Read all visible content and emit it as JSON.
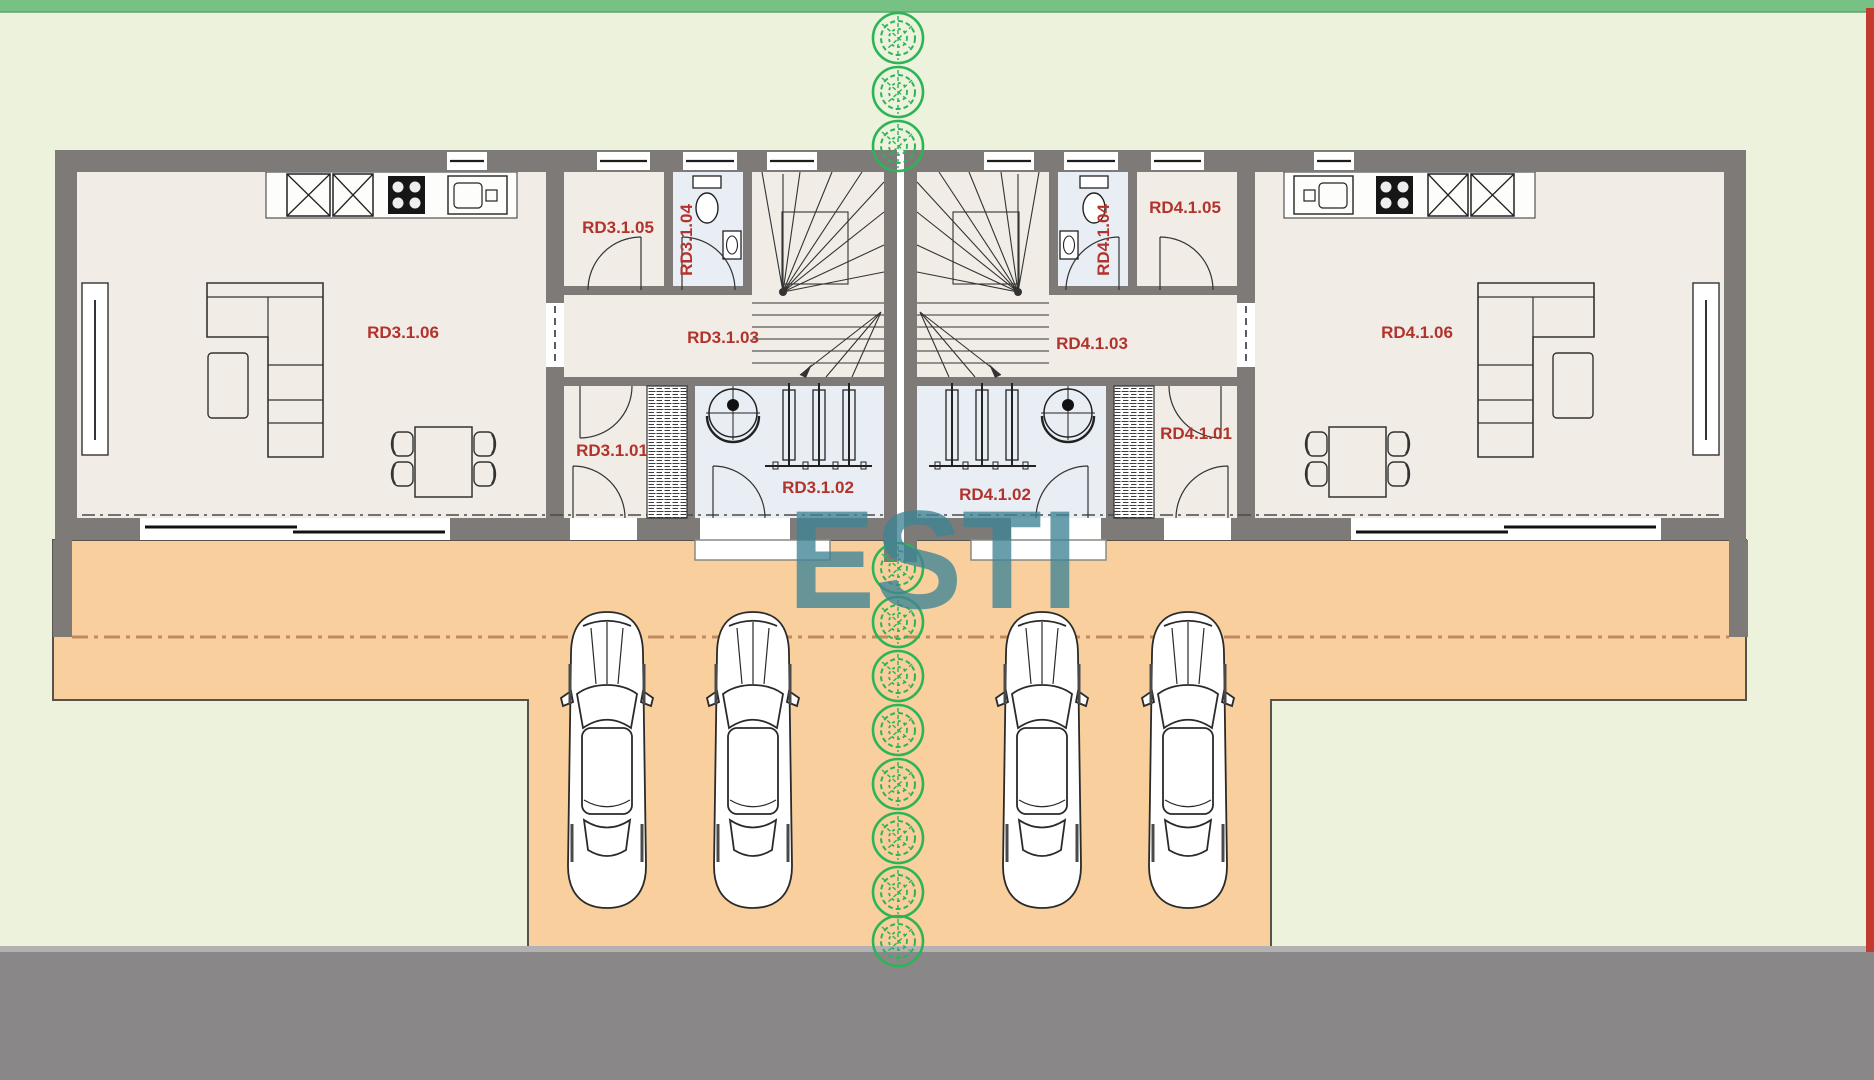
{
  "watermark": {
    "text": "ESTI"
  },
  "units": [
    {
      "id": "RD3",
      "rooms": [
        {
          "code": "RD3.1.01"
        },
        {
          "code": "RD3.1.02"
        },
        {
          "code": "RD3.1.03"
        },
        {
          "code": "RD3.1.04"
        },
        {
          "code": "RD3.1.05"
        },
        {
          "code": "RD3.1.06"
        }
      ]
    },
    {
      "id": "RD4",
      "rooms": [
        {
          "code": "RD4.1.01"
        },
        {
          "code": "RD4.1.02"
        },
        {
          "code": "RD4.1.03"
        },
        {
          "code": "RD4.1.04"
        },
        {
          "code": "RD4.1.05"
        },
        {
          "code": "RD4.1.06"
        }
      ]
    }
  ],
  "colors": {
    "site_green": "#ecf2dc",
    "hedge_green": "#77c185",
    "terrace_orange": "#f8cf9d",
    "terrace_edge": "#55534b",
    "road_gray": "#8a8788",
    "curb_gray": "#b4b1b2",
    "wall_gray": "#7d7a78",
    "interior_cream": "#f1ede6",
    "wet_room_blue": "#e9eef4",
    "label_red": "#b2332c",
    "tree_green": "#2db457",
    "watermark_teal": "#3f8495",
    "boundary_red": "#c23b2e"
  }
}
